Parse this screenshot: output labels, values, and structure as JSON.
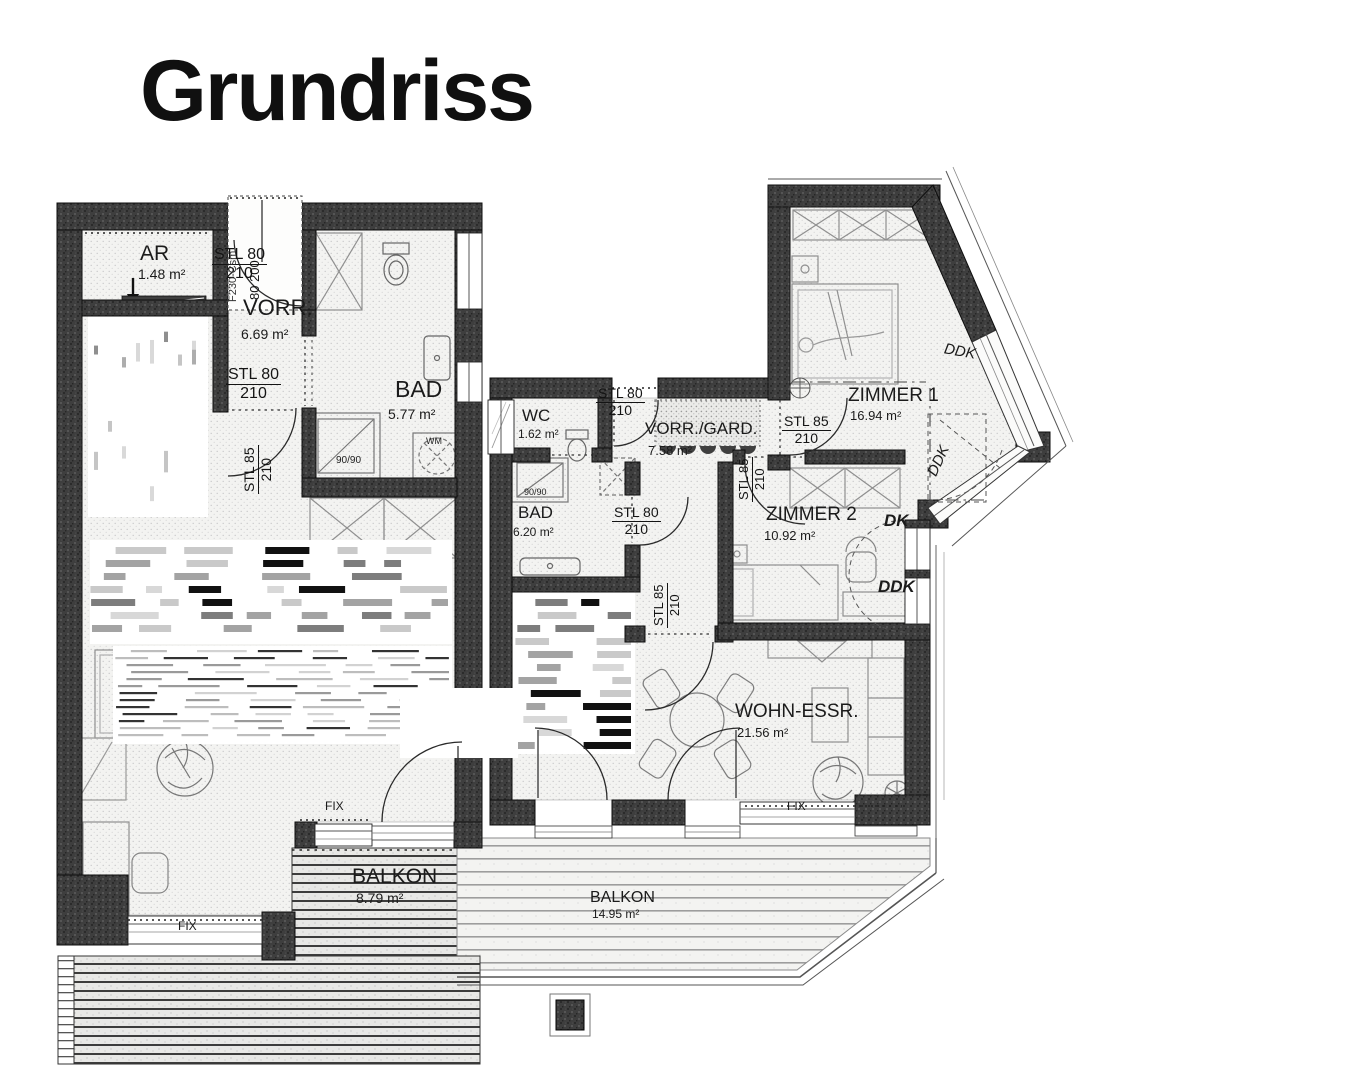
{
  "title": "Grundriss",
  "units": {
    "left": {
      "rooms": {
        "ar": {
          "name": "AR",
          "area": "1.48 m²"
        },
        "vorr": {
          "name": "VORR.",
          "area": "6.69 m²"
        },
        "bad": {
          "name": "BAD",
          "area": "5.77 m²"
        },
        "balkon": {
          "name": "BALKON",
          "area": "8.79 m²"
        }
      }
    },
    "right": {
      "rooms": {
        "wc": {
          "name": "WC",
          "area": "1.62 m²"
        },
        "vorr": {
          "name": "VORR./GARD.",
          "area": "7.58 m²"
        },
        "bad": {
          "name": "BAD",
          "area": "6.20 m²"
        },
        "zimmer1": {
          "name": "ZIMMER 1",
          "area": "16.94 m²"
        },
        "zimmer2": {
          "name": "ZIMMER 2",
          "area": "10.92 m²"
        },
        "wohn": {
          "name": "WOHN-ESSR.",
          "area": "21.56 m²"
        },
        "balkon": {
          "name": "BALKON",
          "area": "14.95 m²"
        }
      }
    }
  },
  "doors": {
    "stl80": "STL 80",
    "stl85": "STL 85",
    "height": "210",
    "entry_leaf": "80 200",
    "entry_code": "F230-Csm"
  },
  "windows": {
    "fix": "FIX",
    "dk": "DK",
    "ddk": "DDK"
  },
  "fixtures": {
    "shower_size": "90/90",
    "washer": "WM"
  }
}
